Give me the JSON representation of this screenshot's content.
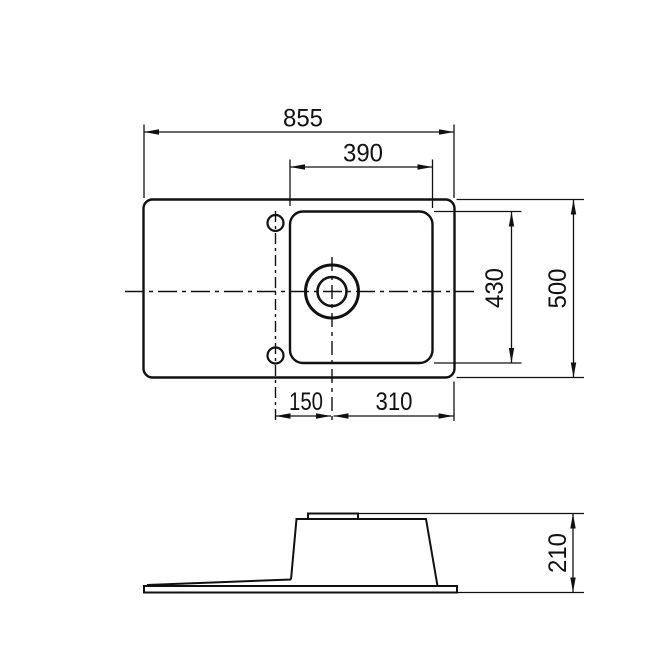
{
  "dimensions": {
    "overall_width": "855",
    "bowl_width": "390",
    "bowl_length": "430",
    "overall_depth": "500",
    "tap_hole_to_drain": "150",
    "drain_to_right_edge": "310",
    "overall_height": "210"
  },
  "colors": {
    "line": "#111111",
    "background": "#ffffff"
  }
}
